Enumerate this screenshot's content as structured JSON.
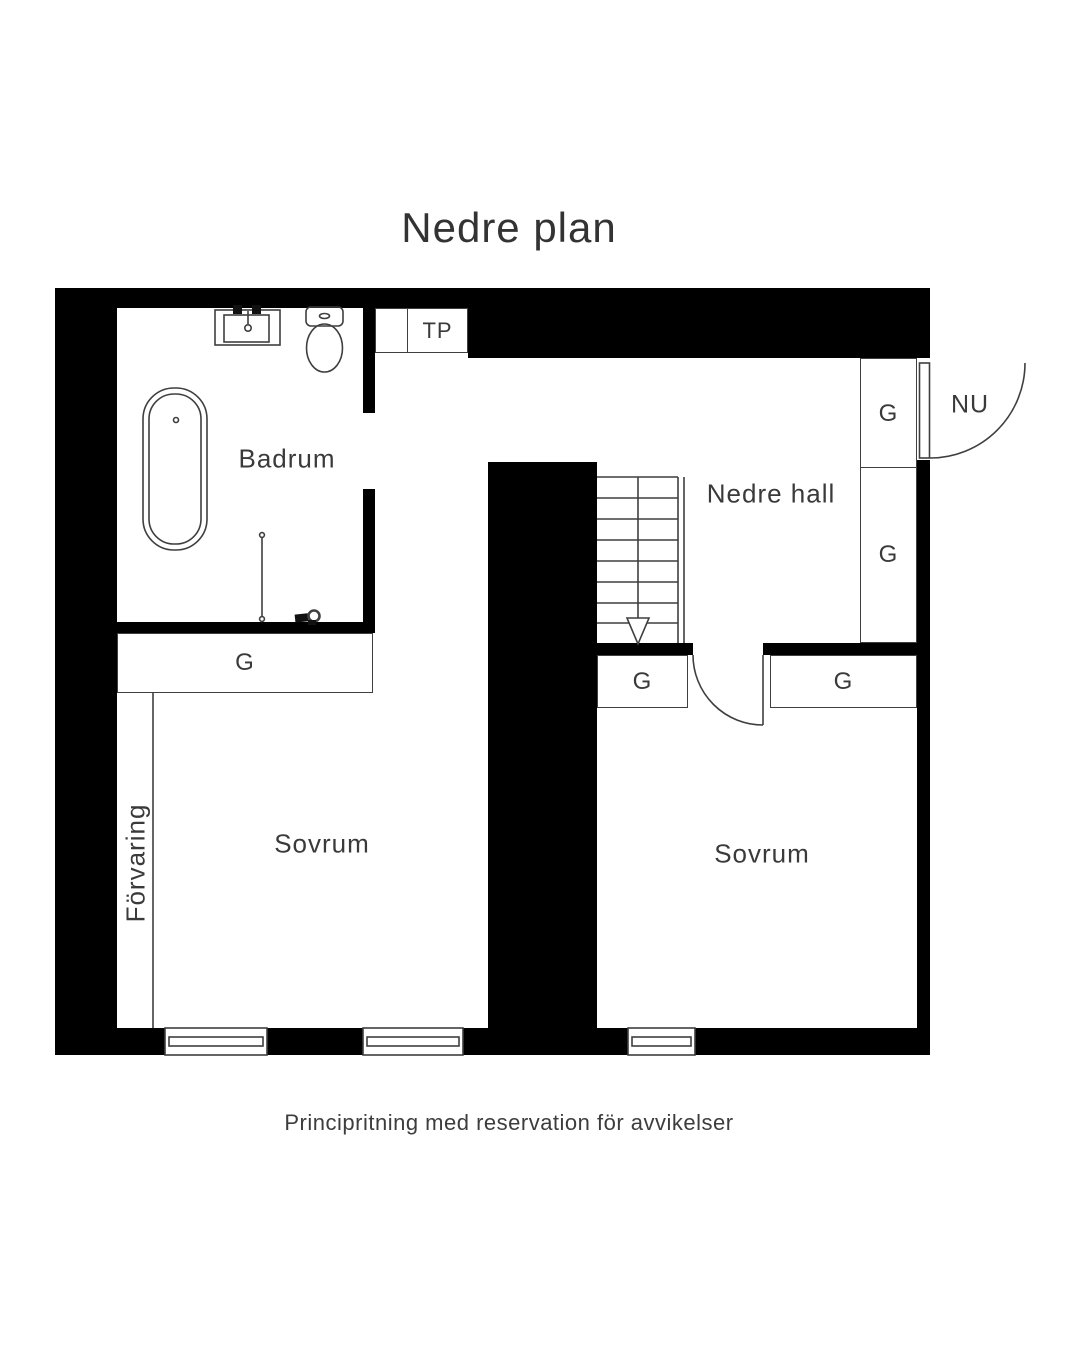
{
  "page": {
    "title": "Nedre plan",
    "caption": "Principritning med reservation för avvikelser"
  },
  "rooms": {
    "bathroom": "Badrum",
    "hall": "Nedre hall",
    "bedroom_left": "Sovrum",
    "bedroom_right": "Sovrum",
    "storage": "Förvaring"
  },
  "closets": {
    "tp": "TP",
    "g_labels": [
      "G",
      "G",
      "G",
      "G",
      "G"
    ]
  },
  "doors": {
    "entrance": "NU"
  },
  "colors": {
    "wall": "#000000",
    "line": "#3f3f3f",
    "text": "#3a3a3a",
    "background": "#ffffff"
  }
}
